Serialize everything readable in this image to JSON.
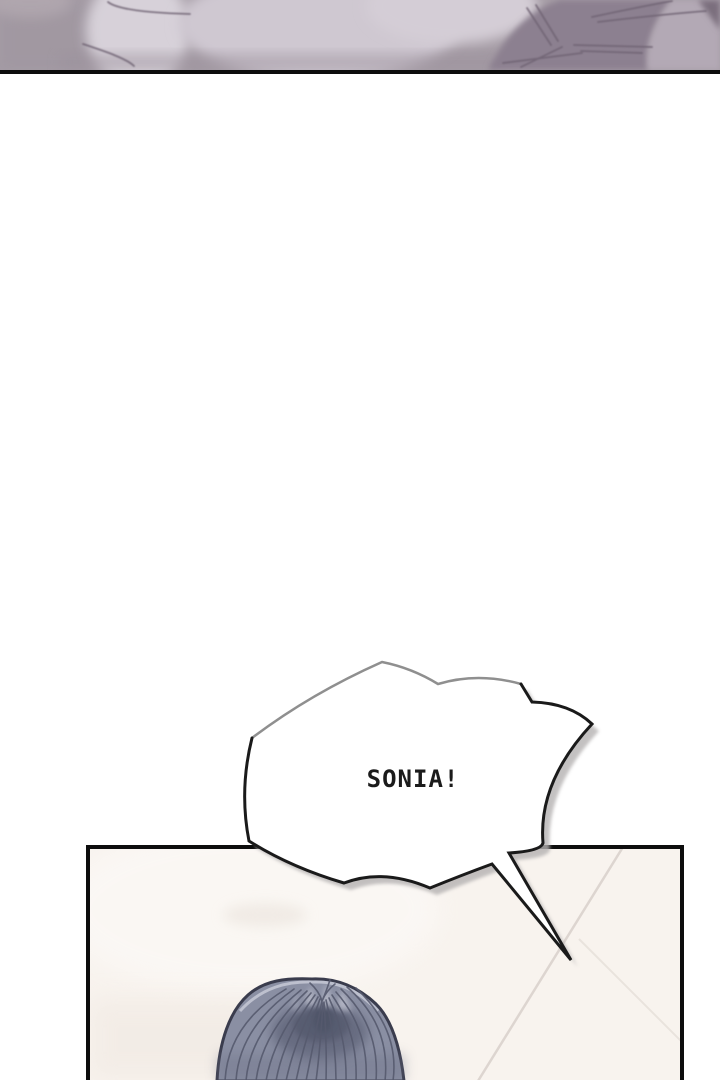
{
  "speech_bubble": {
    "text": "SONIA!"
  },
  "colors": {
    "page_bg": "#ffffff",
    "panel_border": "#0d0d0d",
    "top_panel_base": "#a59ca5",
    "top_panel_light": "#d3ccd5",
    "top_panel_dark": "#8c8090",
    "top_panel_crease": "#6f6373",
    "bottom_panel_bg": "#f8f3ee",
    "wall_seam": "#d9d2cc",
    "hair_base": "#8a8fa3",
    "hair_shadow": "#5f6378",
    "hair_outline": "#3a3c4d",
    "hair_strand": "#565a6e",
    "hair_rim_light": "#c9ccd8",
    "bubble_fill": "#ffffff",
    "bubble_stroke_light": "#8f8f8f",
    "bubble_stroke_dark": "#1a1a1a",
    "bubble_shadow": "#b5b2b2",
    "text_color": "#1b1b1b"
  }
}
